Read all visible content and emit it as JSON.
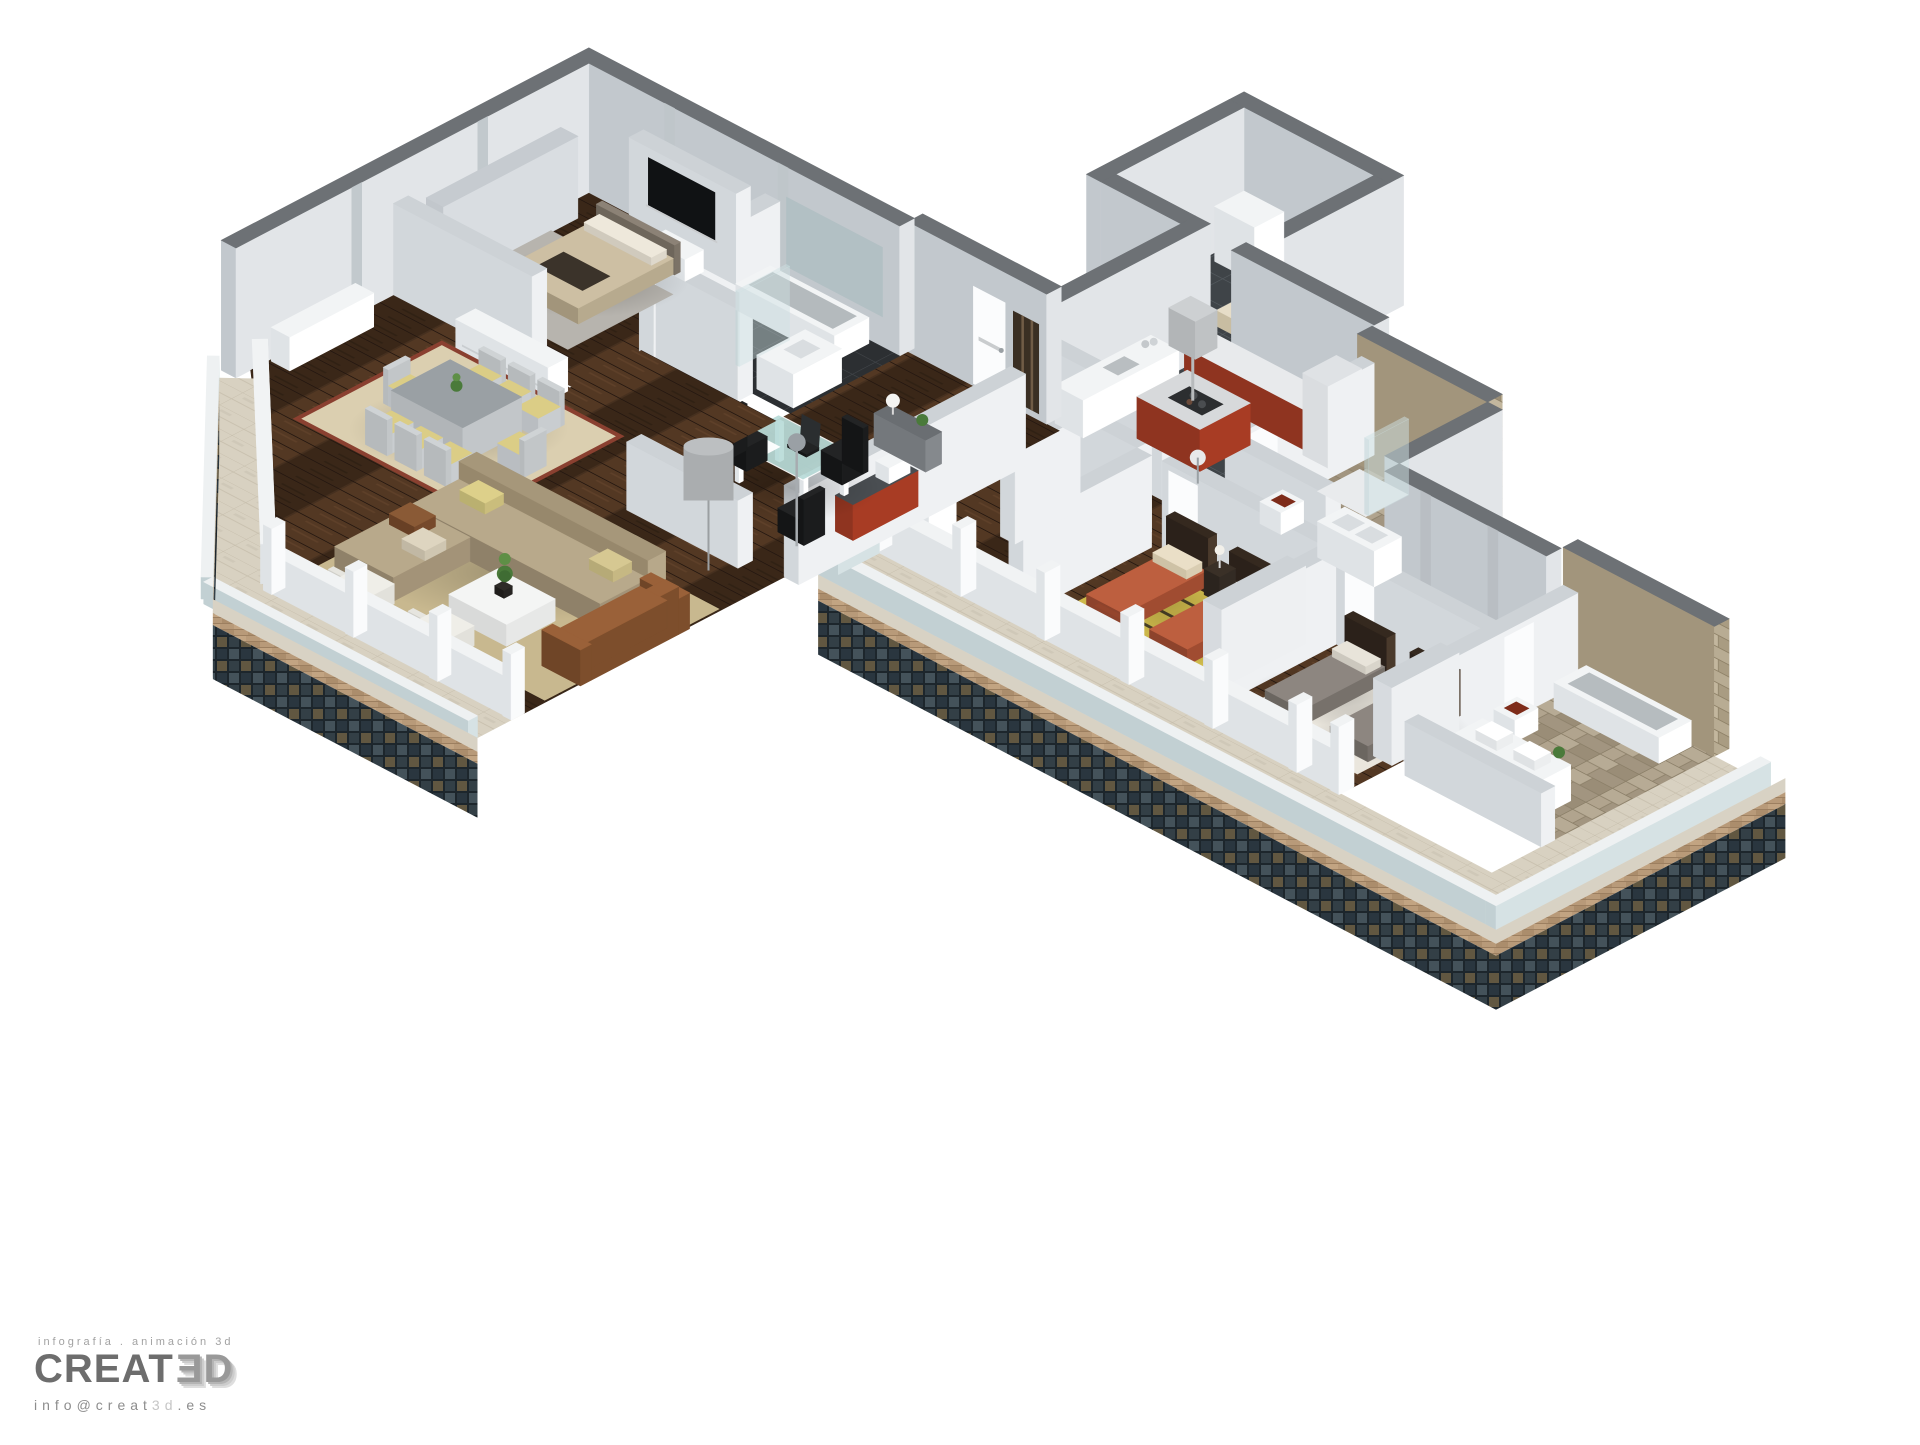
{
  "branding": {
    "tagline": "infografía . animación 3d",
    "brand_main": "CREAT",
    "brand_3d": "ƎD",
    "email_prefix": "info@creat",
    "email_3d": "3d",
    "email_suffix": ".es"
  },
  "palette": {
    "wall_top": "#6d7175",
    "wall_face_light": "#e2e5e8",
    "wall_face_mid": "#c2c8cd",
    "partition_top": "#cdd2d6",
    "partition_face_light": "#eff1f3",
    "partition_face_mid": "#d2d7db",
    "wood_floor": "#46301f",
    "tile_dark": "#3f4448",
    "tile_black": "#2c2f32",
    "stone": "#b3a78f",
    "travertine": "#d8d1c1",
    "kitchen_red": "#a83c24",
    "bed_orange": "#bd5f3f",
    "bed_gray": "#8d8680",
    "sofa_tan": "#b5a687",
    "leather_brown": "#9a6139",
    "rug_yellow": "#d4bf4e",
    "rug_jute": "#c8b88f",
    "rug_dining": "#dbcfb0",
    "desk_glass": "#b9dcd9",
    "facade_mosaic": "#33414a",
    "brick": "#b89a79",
    "white_furniture": "#f2f4f5"
  },
  "rooms": [
    {
      "id": "utility-room"
    },
    {
      "id": "kitchen"
    },
    {
      "id": "corridor"
    },
    {
      "id": "bathroom-1"
    },
    {
      "id": "bedroom-2-twin"
    },
    {
      "id": "bedroom-3"
    },
    {
      "id": "ensuite-bathroom"
    },
    {
      "id": "terrace"
    },
    {
      "id": "entry-hall"
    },
    {
      "id": "home-office"
    },
    {
      "id": "dressing-room"
    },
    {
      "id": "master-bedroom"
    },
    {
      "id": "master-bathroom"
    },
    {
      "id": "living-dining-room"
    },
    {
      "id": "balcony"
    }
  ]
}
